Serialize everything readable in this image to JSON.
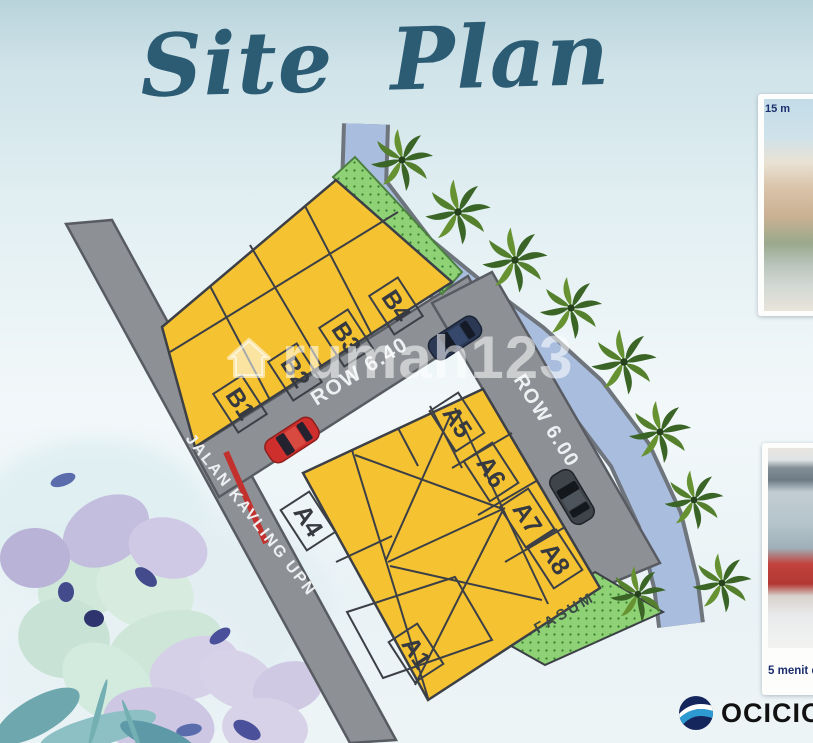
{
  "title": "Site Plan",
  "watermark": {
    "text": "rumah123"
  },
  "map": {
    "road_left_label": "JALAN KAVLING UPN",
    "road_row640_label": "ROW 6.40",
    "road_row600_label": "ROW 6.00",
    "fasum_label": "FASUM",
    "plots_b": [
      "B1",
      "B2",
      "B3",
      "B4"
    ],
    "plots_a": [
      "A4",
      "A5",
      "A6",
      "A7",
      "A8",
      "A1"
    ]
  },
  "cards": [
    {
      "caption": "15 m"
    },
    {
      "caption": "5 menit d"
    }
  ],
  "logo": {
    "text": "OCICIO"
  },
  "colors": {
    "plot_yellow": "#f5c332",
    "road_gray": "#8d9196",
    "river_blue": "#a9bede",
    "fasum_green": "#8fd276",
    "title_teal": "#2c5b74",
    "label_navy": "#1c2f6e"
  }
}
